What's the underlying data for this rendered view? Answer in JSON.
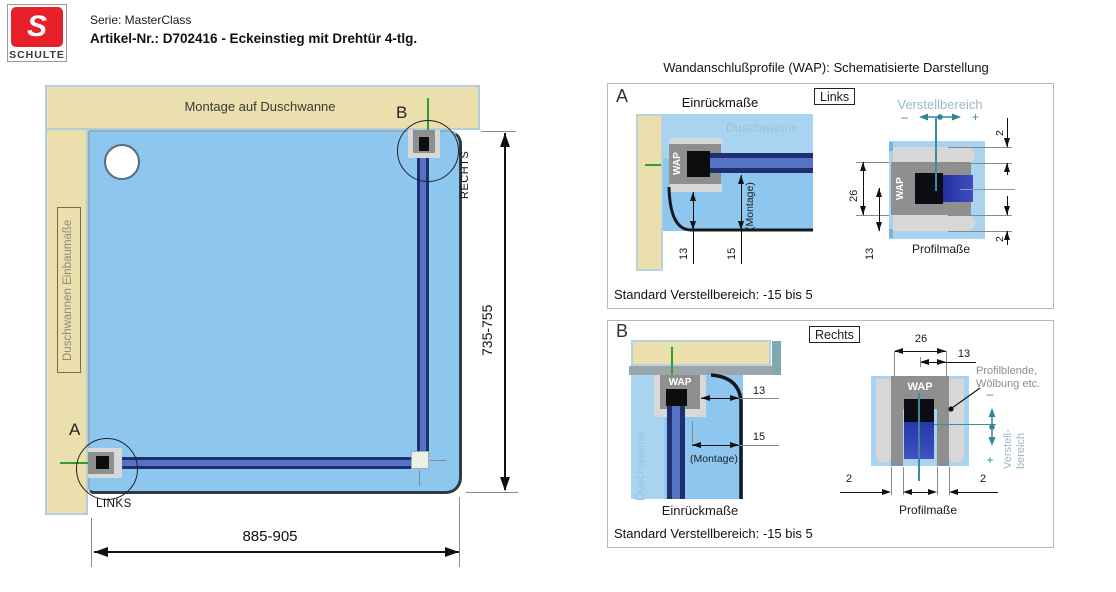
{
  "header": {
    "brand": "SCHULTE",
    "logo_letter": "S",
    "serie": "Serie: MasterClass",
    "artikel": "Artikel-Nr.: D702416 - Eckeinstieg mit Drehtür 4-tlg."
  },
  "main": {
    "wall_top_label": "Montage auf Duschwanne",
    "wall_left_label": "Duschwannen Einbaumaße",
    "dim_width": "885-905",
    "dim_height": "735-755",
    "detail_a_letter": "A",
    "detail_a_label": "LINKS",
    "detail_b_letter": "B",
    "detail_b_label": "RECHTS"
  },
  "right": {
    "title": "Wandanschlußprofile (WAP): Schematisierte Darstellung",
    "a": {
      "letter": "A",
      "heading": "Einrückmaße",
      "side": "Links",
      "verstell": "Verstellbereich",
      "minus": "–",
      "plus": "+",
      "duschwanne": "Duschwanne",
      "wap": "WAP",
      "wap2": "WAP",
      "montage": "(Montage)",
      "d13": "13",
      "d15": "15",
      "d26": "26",
      "d13b": "13",
      "d2top": "2",
      "d2bot": "2",
      "profilmasse": "Profilmaße",
      "standard": "Standard Verstellbereich: -15 bis 5"
    },
    "b": {
      "letter": "B",
      "side": "Rechts",
      "heading": "Einrückmaße",
      "duschwanne": "Duschwanne",
      "wap": "WAP",
      "wap2": "WAP",
      "montage": "(Montage)",
      "d13": "13",
      "d15": "15",
      "d26": "26",
      "d13b": "13",
      "d2l": "2",
      "d2r": "2",
      "profilblende1": "Profilblende,",
      "profilblende2": "Wölbung etc.",
      "vminus": "–",
      "vplus": "+",
      "verstell1": "Verstell-",
      "verstell2": "bereich",
      "profilmasse": "Profilmaße",
      "standard": "Standard Verstellbereich: -15 bis 5"
    }
  },
  "colors": {
    "brand_red": "#e8202a",
    "wall_beige": "#ebdfad",
    "tray_blue": "#8dc7f0",
    "profile_gray": "#8f8f8f",
    "glass_navy": "#1e3070",
    "teal_accent": "#2e8898",
    "green_mark": "#2da02d"
  }
}
